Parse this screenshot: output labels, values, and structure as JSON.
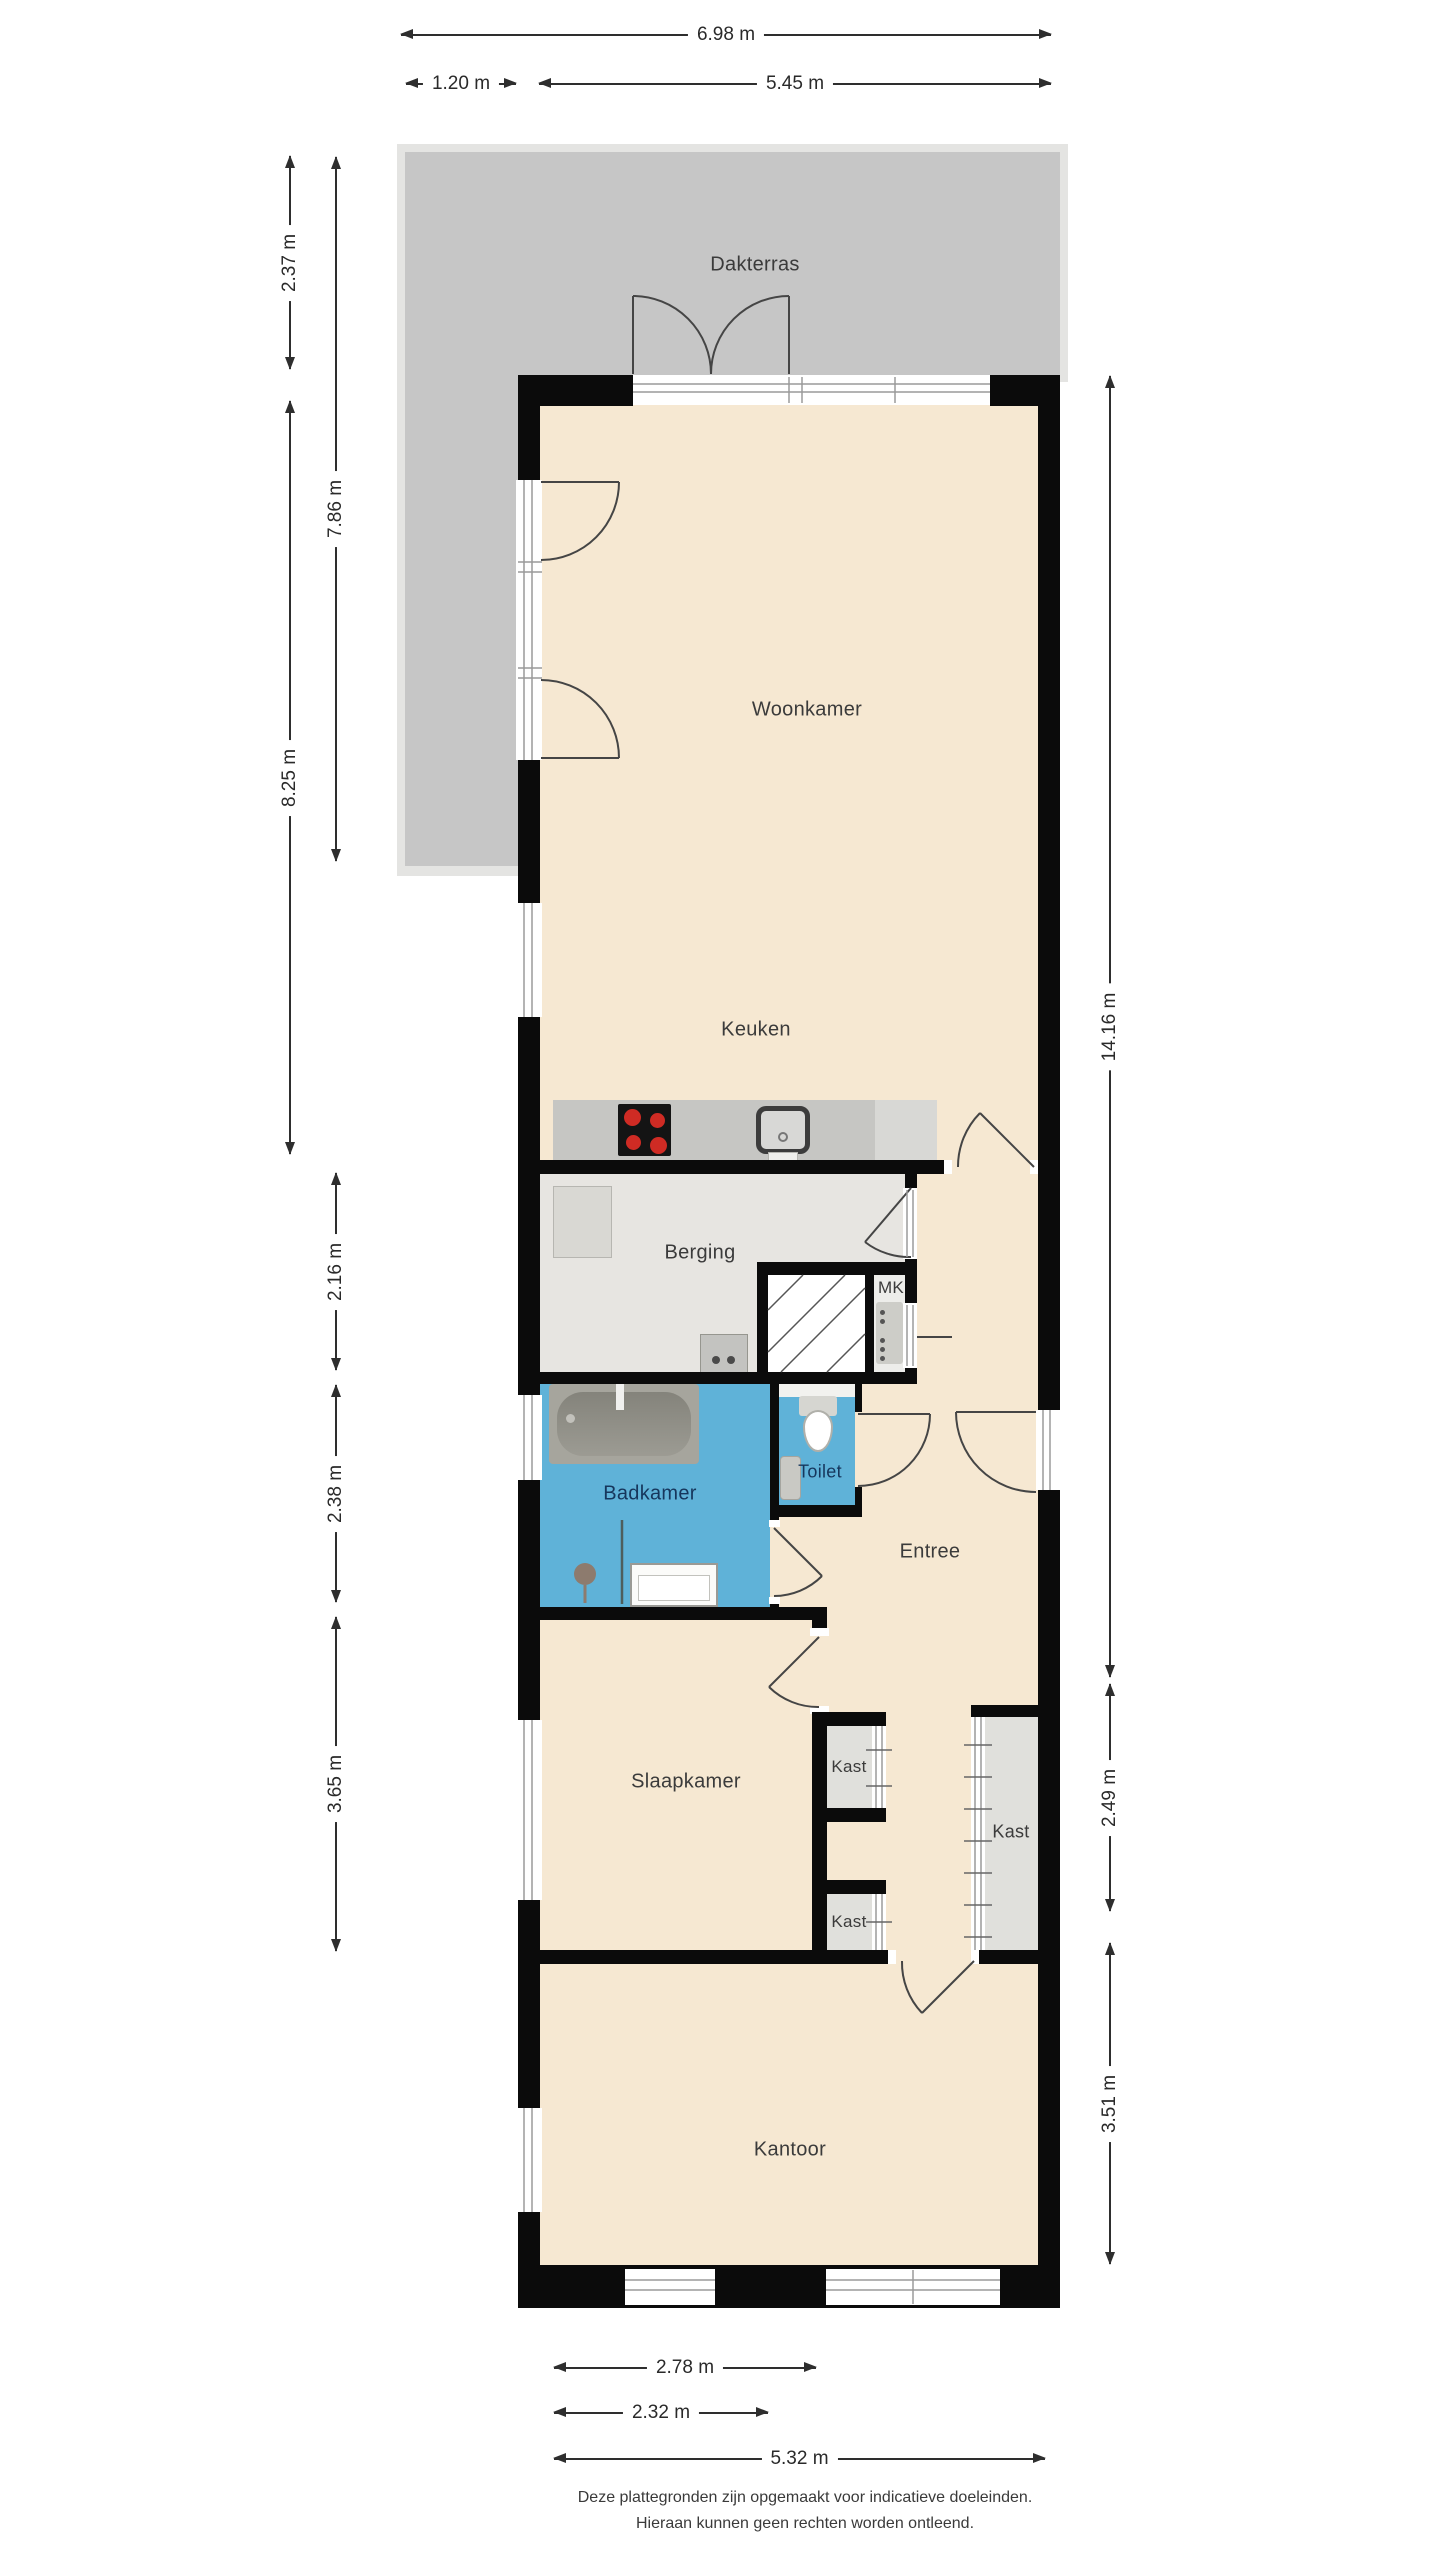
{
  "plan": {
    "type": "floorplan",
    "rooms": {
      "dakterras": "Dakterras",
      "woonkamer": "Woonkamer",
      "keuken": "Keuken",
      "berging": "Berging",
      "mk": "MK",
      "badkamer": "Badkamer",
      "toilet": "Toilet",
      "entree": "Entree",
      "slaapkamer": "Slaapkamer",
      "kast_hall_top": "Kast",
      "kast_hall_bottom": "Kast",
      "kast_wardrobe": "Kast",
      "kantoor": "Kantoor"
    },
    "dimensions": {
      "top_total": "6.98 m",
      "top_terrace": "1.20 m",
      "top_building": "5.45 m",
      "left_terrace": "2.37 m",
      "left_terrace_total": "7.86 m",
      "left_living": "8.25 m",
      "left_storage": "2.16 m",
      "left_bathroom": "2.38 m",
      "left_bedroom": "3.65 m",
      "right_total": "14.16 m",
      "right_closet": "2.49 m",
      "right_office": "3.51 m",
      "bottom_bedroom": "2.78 m",
      "bottom_bathroom": "2.32 m",
      "bottom_total": "5.32 m"
    },
    "disclaimer": {
      "line1": "Deze plattegronden zijn opgemaakt voor indicatieve doeleinden.",
      "line2": "Hieraan kunnen geen rechten worden ontleend."
    },
    "colors": {
      "floor_beige": "#f6e8d2",
      "terrace_gray": "#c6c6c6",
      "terrace_border": "#e4e4e2",
      "wet_room_blue": "#5fb2d8",
      "storage_gray": "#e7e5e1",
      "closet_gray": "#e0e0dc",
      "counter_gray": "#c6c6c3",
      "wall_black": "#0b0b0b",
      "label_dark": "#3b3b3b",
      "label_navy": "#16365c"
    }
  }
}
